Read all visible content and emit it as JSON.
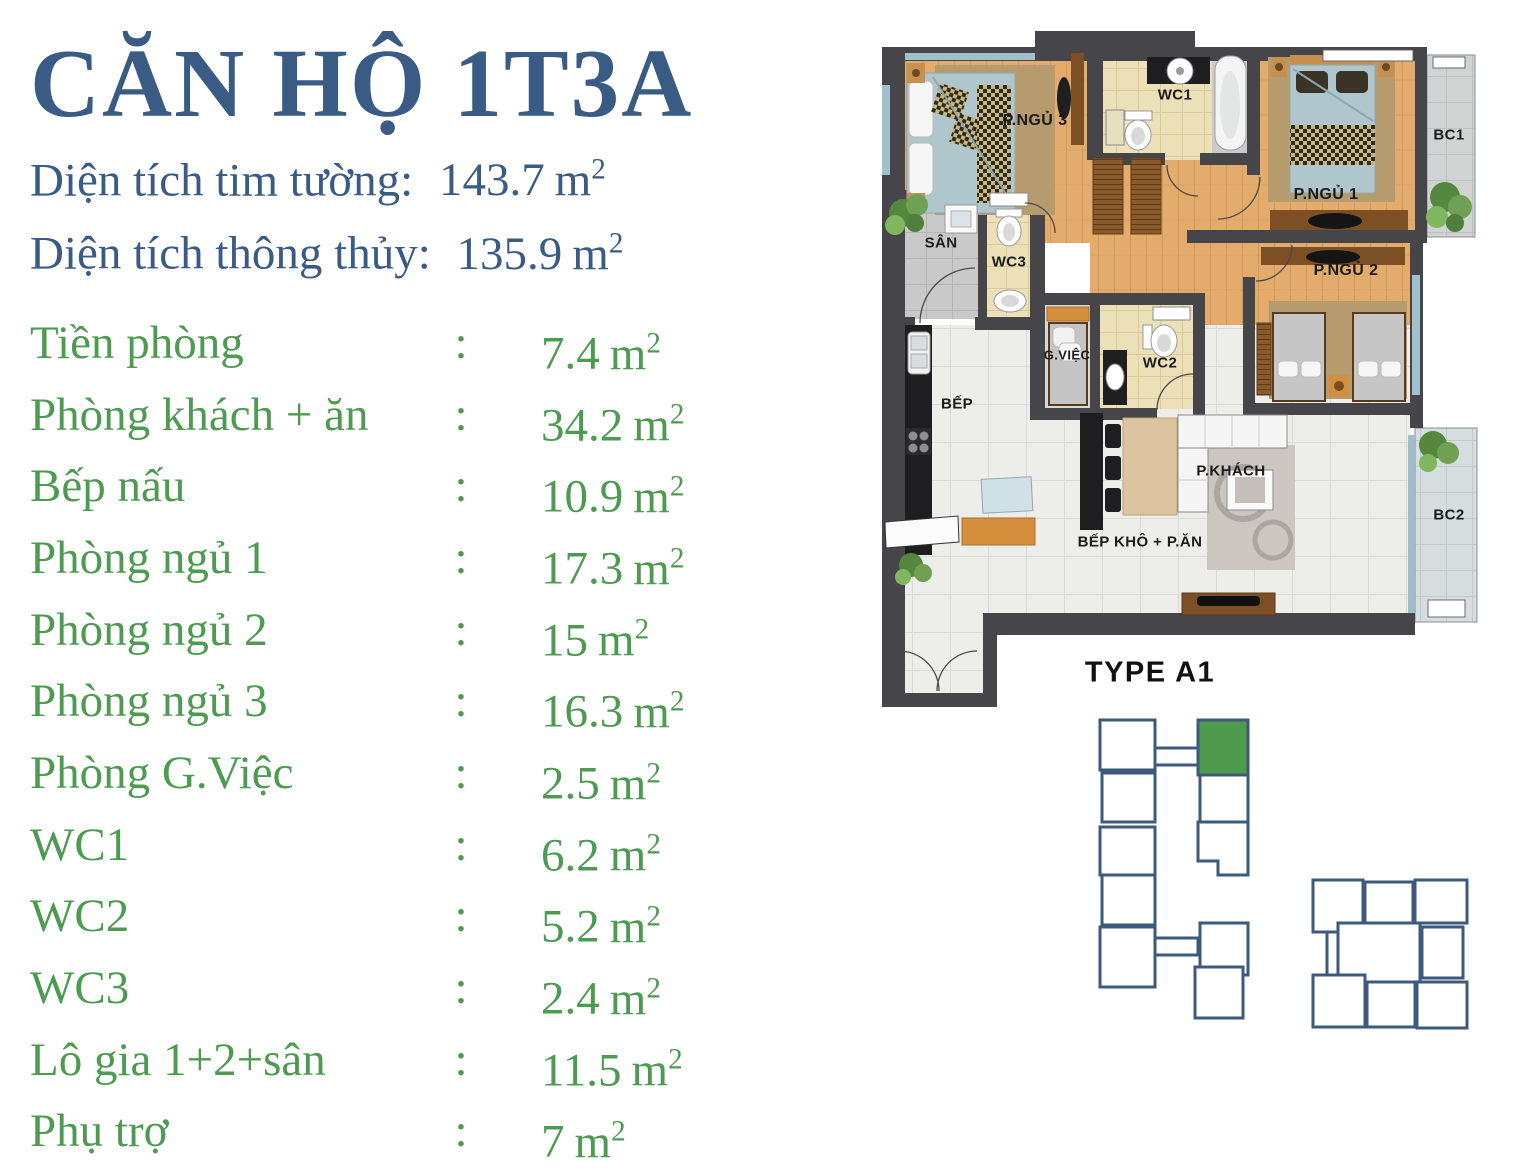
{
  "header": {
    "title": "CĂN HỘ 1T3A",
    "area_lines": [
      {
        "label": "Diện tích tim tường:",
        "value": "143.7"
      },
      {
        "label": "Diện tích thông thủy:",
        "value": "135.9"
      }
    ]
  },
  "separator": ":",
  "unit": {
    "base": "m",
    "exponent": "2"
  },
  "room_areas": [
    {
      "label": "Tiền phòng",
      "value": "7.4"
    },
    {
      "label": "Phòng khách + ăn",
      "value": "34.2"
    },
    {
      "label": "Bếp nấu",
      "value": "10.9"
    },
    {
      "label": "Phòng ngủ 1",
      "value": "17.3"
    },
    {
      "label": "Phòng ngủ 2",
      "value": "15"
    },
    {
      "label": "Phòng ngủ 3",
      "value": "16.3"
    },
    {
      "label": "Phòng G.Việc",
      "value": "2.5"
    },
    {
      "label": "WC1",
      "value": "6.2"
    },
    {
      "label": "WC2",
      "value": "5.2"
    },
    {
      "label": "WC3",
      "value": "2.4"
    },
    {
      "label": "Lô gia 1+2+sân",
      "value": "11.5"
    },
    {
      "label": "Phụ trợ",
      "value": "7"
    }
  ],
  "floorplan": {
    "type_label": "TYPE A1",
    "labels": {
      "pngu3": "P.NGỦ 3",
      "wc1": "WC1",
      "pngu1": "P.NGỦ 1",
      "bc1": "BC1",
      "san": "SÂN",
      "wc3": "WC3",
      "pngu2": "P.NGỦ 2",
      "gviec": "G.VIỆC",
      "wc2": "WC2",
      "bep": "BẾP",
      "bep_kho": "BẾP KHÔ + P.ĂN",
      "pkhach": "P.KHÁCH",
      "bc2": "BC2"
    }
  },
  "colors": {
    "title_blue": "#3A5B84",
    "list_green": "#4D9A51",
    "label_text": "#1B1B1B",
    "keyplan_outline": "#3C5A7C",
    "keyplan_highlight": "#4E9B4E",
    "wall_dark": "#46464A",
    "wood_floor": "#E3AC6D"
  }
}
